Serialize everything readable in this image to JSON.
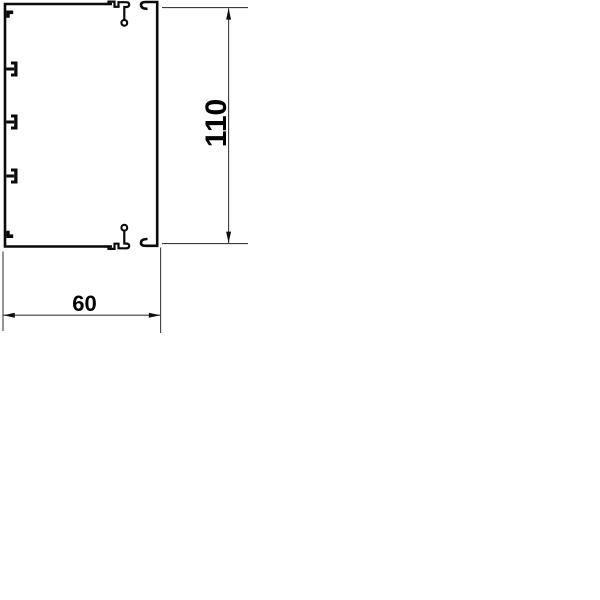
{
  "diagram": {
    "type": "technical-cross-section-drawing",
    "subject": "cable-trunking-profile-with-cover",
    "background_color": "#ffffff",
    "line_color": "#0a0a0a",
    "dimension_line_color": "#3c3c3c",
    "text_color": "#000000",
    "dimensions": [
      {
        "id": "height",
        "label": "110",
        "orientation": "vertical"
      },
      {
        "id": "width",
        "label": "60",
        "orientation": "horizontal"
      }
    ],
    "parts": [
      {
        "name": "trunking-base-profile",
        "features": "left wall with one top clip tab, three T-shaped retaining tabs, one bottom clip tab, top and bottom walls ending in snap hooks with round feet"
      },
      {
        "name": "trunking-cover-profile",
        "features": "vertical cover wall with curled return lips at top and bottom"
      }
    ]
  }
}
